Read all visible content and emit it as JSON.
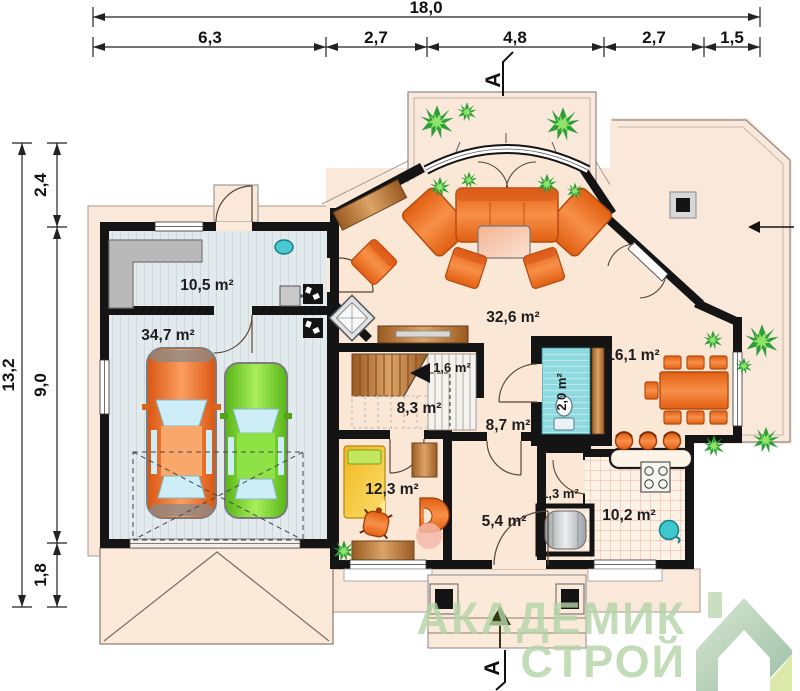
{
  "dimensions": {
    "top_total": "18,0",
    "top_segments": [
      "6,3",
      "2,7",
      "4,8",
      "2,7",
      "1,5"
    ],
    "left_total": "13,2",
    "left_segments": [
      "2,4",
      "9,0",
      "1,8"
    ]
  },
  "section_marker": "A",
  "rooms": {
    "utility": "10,5 m²",
    "garage": "34,7 m²",
    "living_room": "32,6 m²",
    "stair_closet": "1,6 m²",
    "hall": "8,3 m²",
    "vestibule": "8,7 m²",
    "wc": "2,0 m²",
    "dining_room": "16,1 m²",
    "bedroom": "12,3 m²",
    "entry": "5,4 m²",
    "pantry": "1,3 m²",
    "kitchen": "10,2 m²"
  },
  "watermark": {
    "line1": "АКАДЕМИК",
    "line2": "СТРОЙ"
  },
  "icons": {
    "plant": "green star-burst foliage",
    "entrance_arrow": "filled triangle pointing up",
    "stairs_arrow": "filled triangle pointing left",
    "section_marker": "letter A with bracket line",
    "logo_house": "green house with folded corner"
  },
  "colors": {
    "wall": "#141414",
    "floor": "#fbe7d6",
    "terrace": "#fae8da",
    "garage_floor": "#dfe8ec",
    "furniture_orange": "#ef7d2b",
    "wood": "#c07a3a",
    "car_orange": "#f07030",
    "car_green": "#6ecb2a",
    "teal": "#3ec7cd",
    "watermark_green": "#b5d4a7"
  }
}
